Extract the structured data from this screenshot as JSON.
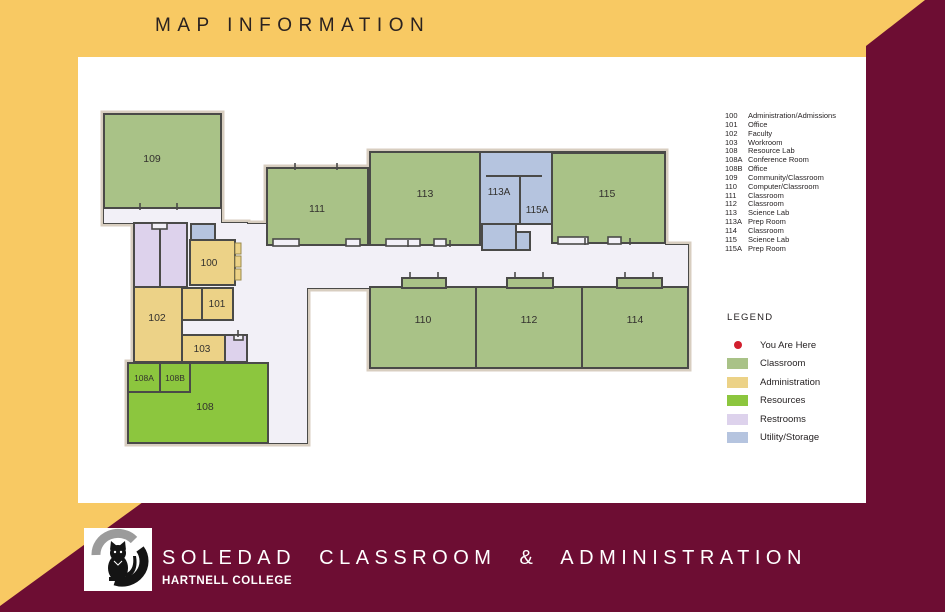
{
  "header": {
    "title": "MAP INFORMATION"
  },
  "footer": {
    "title": "SOLEDAD CLASSROOM & ADMINISTRATION",
    "subtitle": "HARTNELL COLLEGE",
    "logo": "panther-logo"
  },
  "colors": {
    "gold": "#F8C963",
    "maroon": "#6D0D33",
    "panel": "#FFFFFF",
    "hall": "#F2F0F7",
    "outline": "#D8CEC0",
    "wall": "#4A4A48",
    "classroom": "#A9C287",
    "admin": "#ECD287",
    "resource": "#8CC63E",
    "restroom": "#DDD2EC",
    "utility": "#B5C4DF",
    "here_dot": "#D21F2E",
    "label_text": "#33312E"
  },
  "room_list": [
    {
      "num": "100",
      "name": "Administration/Admissions"
    },
    {
      "num": "101",
      "name": "Office"
    },
    {
      "num": "102",
      "name": "Faculty"
    },
    {
      "num": "103",
      "name": "Workroom"
    },
    {
      "num": "108",
      "name": "Resource Lab"
    },
    {
      "num": "108A",
      "name": "Conference Room"
    },
    {
      "num": "108B",
      "name": "Office"
    },
    {
      "num": "109",
      "name": "Community/Classroom"
    },
    {
      "num": "110",
      "name": "Computer/Classroom"
    },
    {
      "num": "111",
      "name": "Classroom"
    },
    {
      "num": "112",
      "name": "Classroom"
    },
    {
      "num": "113",
      "name": "Science Lab"
    },
    {
      "num": "113A",
      "name": "Prep Room"
    },
    {
      "num": "114",
      "name": "Classroom"
    },
    {
      "num": "115",
      "name": "Science Lab"
    },
    {
      "num": "115A",
      "name": "Prep Room"
    }
  ],
  "legend": {
    "title": "LEGEND",
    "items": [
      {
        "label": "You Are Here",
        "swatch": "dot",
        "color": "#D21F2E"
      },
      {
        "label": "Classroom",
        "swatch": "rect",
        "color": "#A9C287"
      },
      {
        "label": "Administration",
        "swatch": "rect",
        "color": "#ECD287"
      },
      {
        "label": "Resources",
        "swatch": "rect",
        "color": "#8CC63E"
      },
      {
        "label": "Restrooms",
        "swatch": "rect",
        "color": "#DDD2EC"
      },
      {
        "label": "Utility/Storage",
        "swatch": "rect",
        "color": "#B5C4DF"
      }
    ]
  },
  "map": {
    "rooms": [
      {
        "id": "109",
        "label": "109",
        "type": "classroom",
        "x": 14,
        "y": 14,
        "w": 117,
        "h": 94,
        "lx": 62,
        "ly": 62
      },
      {
        "id": "restroom-1",
        "label": "",
        "type": "restroom",
        "x": 44,
        "y": 123,
        "w": 26,
        "h": 64
      },
      {
        "id": "restroom-2",
        "label": "",
        "type": "restroom",
        "x": 70,
        "y": 123,
        "w": 27,
        "h": 64
      },
      {
        "id": "utility-1",
        "label": "",
        "type": "utility",
        "x": 101,
        "y": 124,
        "w": 24,
        "h": 16
      },
      {
        "id": "100",
        "label": "100",
        "type": "admin",
        "x": 100,
        "y": 140,
        "w": 45,
        "h": 45,
        "lx": 119,
        "ly": 166,
        "fs": 10
      },
      {
        "id": "102",
        "label": "102",
        "type": "admin",
        "x": 44,
        "y": 187,
        "w": 48,
        "h": 75,
        "lx": 67,
        "ly": 221
      },
      {
        "id": "101b",
        "label": "",
        "type": "admin",
        "x": 92,
        "y": 188,
        "w": 20,
        "h": 32
      },
      {
        "id": "101",
        "label": "101",
        "type": "admin",
        "x": 112,
        "y": 188,
        "w": 31,
        "h": 32,
        "lx": 127,
        "ly": 207,
        "fs": 10
      },
      {
        "id": "103",
        "label": "103",
        "type": "admin",
        "x": 92,
        "y": 235,
        "w": 43,
        "h": 27,
        "lx": 112,
        "ly": 252,
        "fs": 10
      },
      {
        "id": "restroom-3",
        "label": "",
        "type": "restroom",
        "x": 135,
        "y": 235,
        "w": 22,
        "h": 27
      },
      {
        "id": "108",
        "label": "108",
        "type": "resource",
        "x": 38,
        "y": 263,
        "w": 140,
        "h": 80,
        "lx": 115,
        "ly": 310
      },
      {
        "id": "108A",
        "label": "108A",
        "type": "resource",
        "x": 38,
        "y": 263,
        "w": 32,
        "h": 29,
        "lx": 54,
        "ly": 281,
        "fs": 8.5
      },
      {
        "id": "108B",
        "label": "108B",
        "type": "resource",
        "x": 70,
        "y": 263,
        "w": 30,
        "h": 29,
        "lx": 85,
        "ly": 281,
        "fs": 8.5
      },
      {
        "id": "111",
        "label": "111",
        "type": "classroom",
        "x": 177,
        "y": 68,
        "w": 101,
        "h": 77,
        "lx": 227,
        "ly": 112
      },
      {
        "id": "113",
        "label": "113",
        "type": "classroom",
        "x": 280,
        "y": 52,
        "w": 110,
        "h": 93,
        "lx": 335,
        "ly": 97
      },
      {
        "id": "utility-113",
        "label": "",
        "type": "utility",
        "x": 390,
        "y": 52,
        "w": 72,
        "h": 72
      },
      {
        "id": "utility-a",
        "label": "",
        "type": "utility",
        "x": 392,
        "y": 124,
        "w": 34,
        "h": 26
      },
      {
        "id": "utility-b",
        "label": "",
        "type": "utility",
        "x": 426,
        "y": 132,
        "w": 14,
        "h": 18
      },
      {
        "id": "115",
        "label": "115",
        "type": "classroom",
        "x": 462,
        "y": 53,
        "w": 113,
        "h": 90,
        "lx": 517,
        "ly": 97
      },
      {
        "id": "110",
        "label": "110",
        "type": "classroom",
        "x": 280,
        "y": 187,
        "w": 106,
        "h": 81,
        "lx": 333,
        "ly": 223
      },
      {
        "id": "112",
        "label": "112",
        "type": "classroom",
        "x": 386,
        "y": 187,
        "w": 106,
        "h": 81,
        "lx": 439,
        "ly": 223
      },
      {
        "id": "114",
        "label": "114",
        "type": "classroom",
        "x": 492,
        "y": 187,
        "w": 106,
        "h": 81,
        "lx": 545,
        "ly": 223
      }
    ],
    "floating_labels": [
      {
        "id": "113A",
        "label": "113A",
        "lx": 409,
        "ly": 95,
        "fs": 10
      },
      {
        "id": "115A",
        "label": "115A",
        "lx": 447,
        "ly": 113,
        "fs": 10
      }
    ]
  }
}
